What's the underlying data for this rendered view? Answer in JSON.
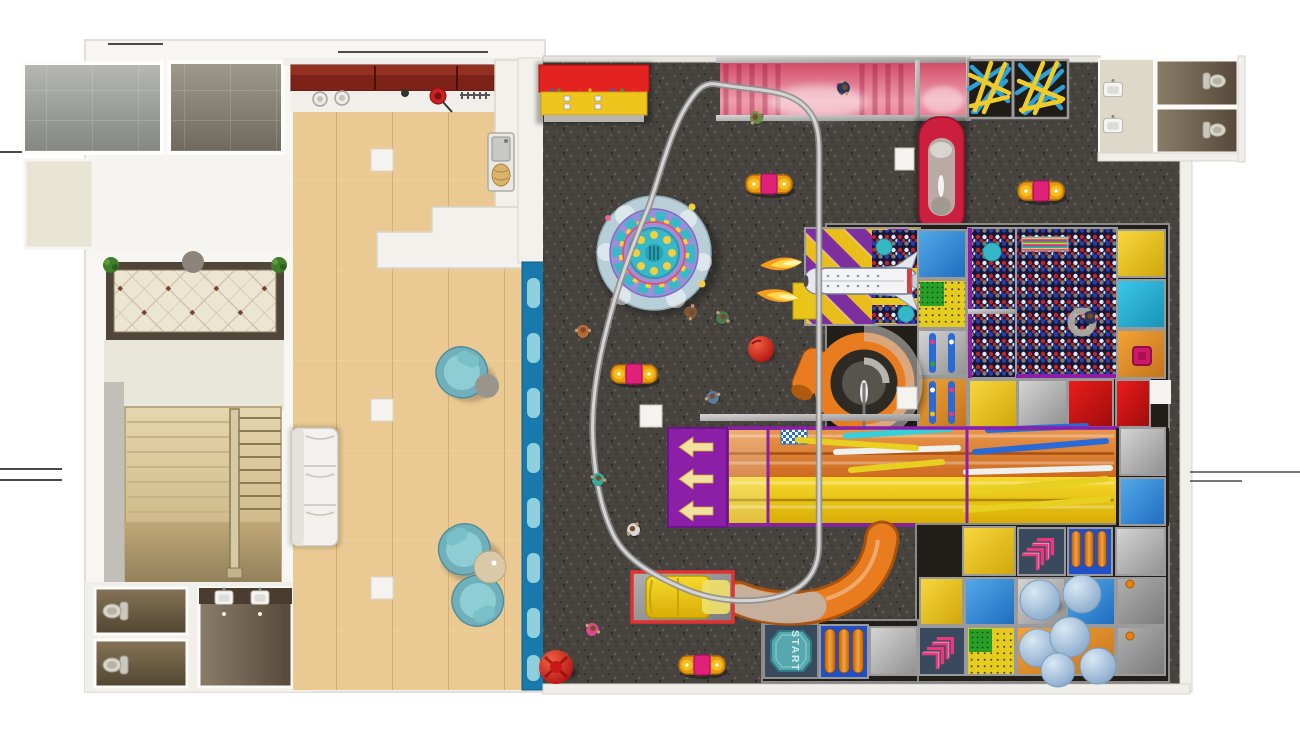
{
  "scene": {
    "kind": "indoor-playground-floorplan-render",
    "view": "top-down"
  },
  "signs": {
    "start_label": "START"
  },
  "palette": {
    "outside": "#ffffff",
    "wall": "#efeee9",
    "carpet": "#474440",
    "wood": "#ebc992",
    "blue_divider": "#1879ad",
    "divider_tab": "#8fd0dc",
    "reception_red": "#e42320",
    "reception_yellow": "#edc51c",
    "pink_zone": "#e0506e",
    "purple": "#8b1fa8",
    "slide_orange": "#df7b28",
    "slide_yellow": "#f0c713",
    "ballpit_navy": "#16173a",
    "mat_red": "#d51414",
    "mat_blue": "#2f86d4",
    "mat_yellow": "#ecc422",
    "mat_orange": "#e2902e",
    "mat_gray": "#b9b9b9",
    "mat_cyan": "#2ab4d8",
    "navy_panel": "#3a4a5e",
    "chevron_pink": "#e8387e",
    "teal_chair": "#6fb0bc",
    "carousel_teal": "#38b8c8",
    "carousel_purple": "#9b8fd8",
    "rail_gray": "#d4d4d4",
    "tube_orange": "#e87c1e",
    "tube_red": "#cc1f3d",
    "ball_blue": "#a9c7e2",
    "start_teal": "#57a8ae",
    "grass_green": "#3f7d2c",
    "flame_orange": "#f59b1e"
  },
  "zones": [
    {
      "id": "utility-room-a"
    },
    {
      "id": "utility-room-b"
    },
    {
      "id": "entry-lobby-carpet"
    },
    {
      "id": "staircase"
    },
    {
      "id": "restrooms-left"
    },
    {
      "id": "cafe-lounge"
    },
    {
      "id": "kitchen-counter"
    },
    {
      "id": "shoe-wall-divider"
    },
    {
      "id": "reception-desk"
    },
    {
      "id": "pink-climb-zone"
    },
    {
      "id": "rope-crisscross-zone"
    },
    {
      "id": "restrooms-right"
    },
    {
      "id": "red-tube-slide"
    },
    {
      "id": "toddler-carousel"
    },
    {
      "id": "rail-ride-track"
    },
    {
      "id": "space-shuttle-ballpit"
    },
    {
      "id": "ball-pit-small"
    },
    {
      "id": "ball-pit-large"
    },
    {
      "id": "spiral-tube-slide"
    },
    {
      "id": "wave-slides"
    },
    {
      "id": "slide-landing-arrows"
    },
    {
      "id": "stick-crossing"
    },
    {
      "id": "start-pad"
    },
    {
      "id": "roller-crawl"
    },
    {
      "id": "chevron-panel"
    },
    {
      "id": "wrecking-balls"
    },
    {
      "id": "mat-grid"
    },
    {
      "id": "yellow-slide-exit-box"
    }
  ],
  "furniture": {
    "sofa": 1,
    "armchairs": 3,
    "coffee_tables": 2,
    "stools": 3
  },
  "figures": {
    "children_visible": 10
  }
}
